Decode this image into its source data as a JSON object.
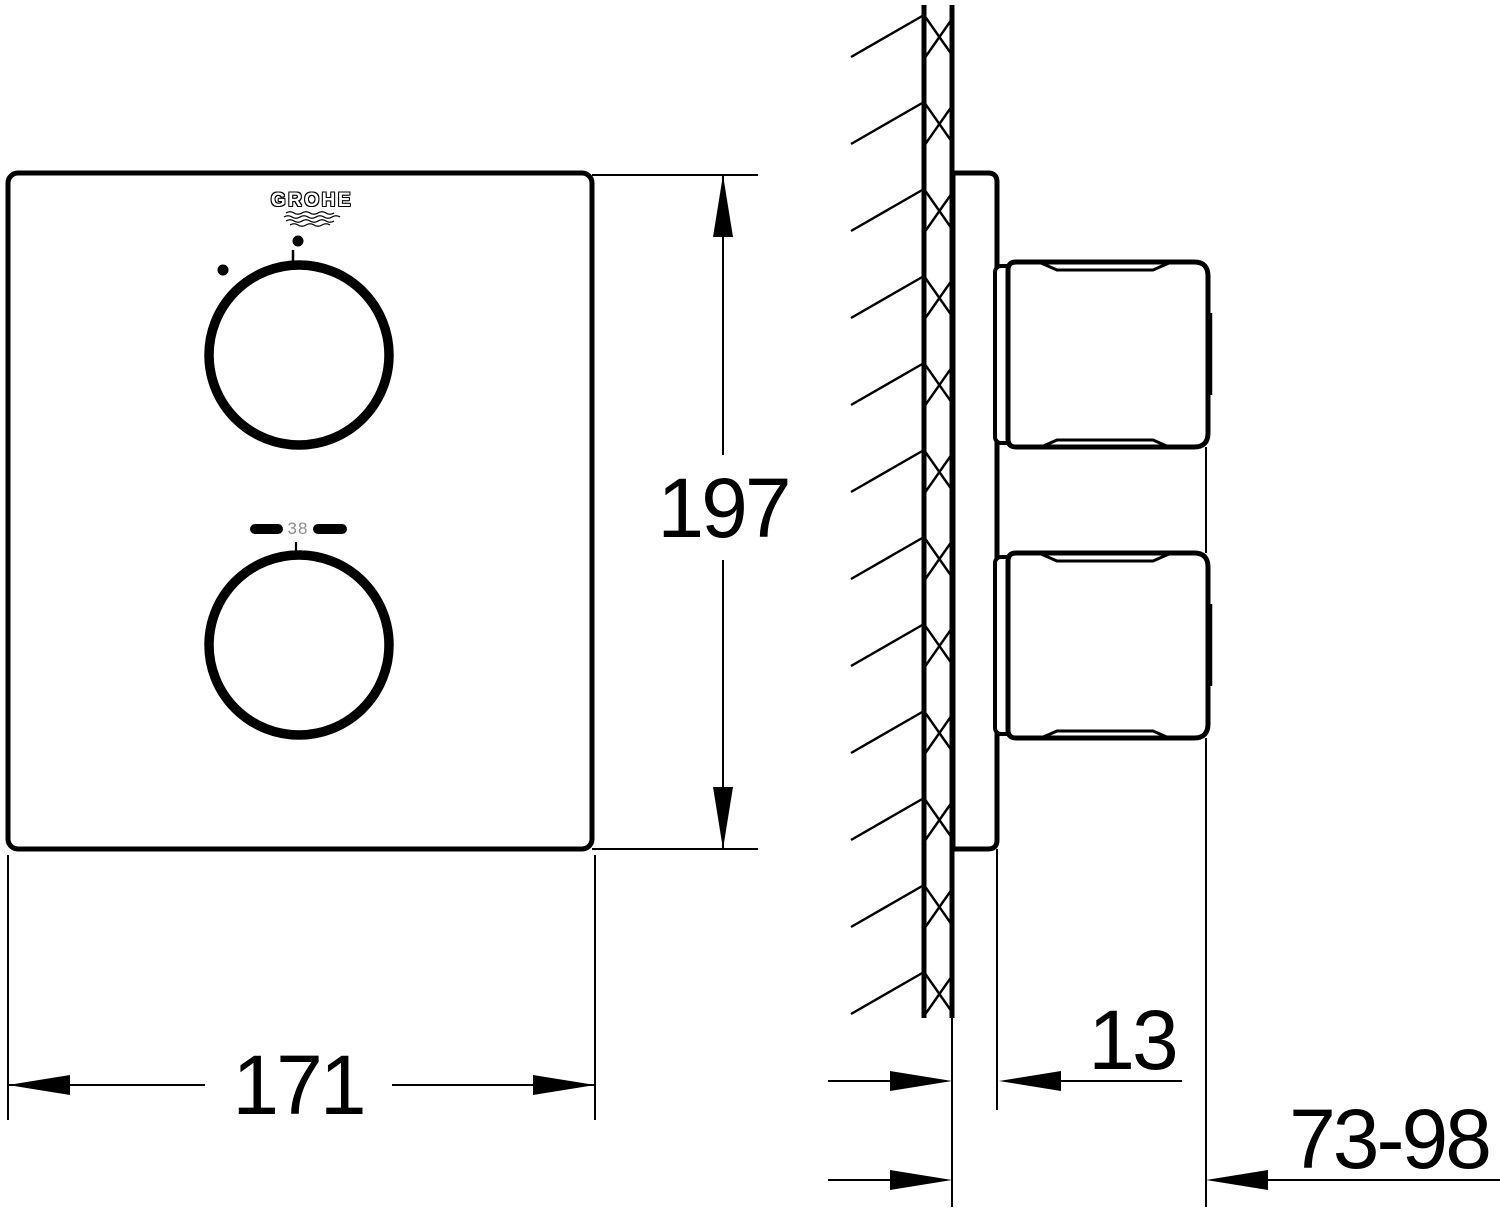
{
  "front_view": {
    "logo": "GROHE",
    "temperature_marking": "38"
  },
  "dimensions": {
    "height": "197",
    "width": "171",
    "wall_plate_depth": "13",
    "installation_depth_range": "73-98"
  }
}
